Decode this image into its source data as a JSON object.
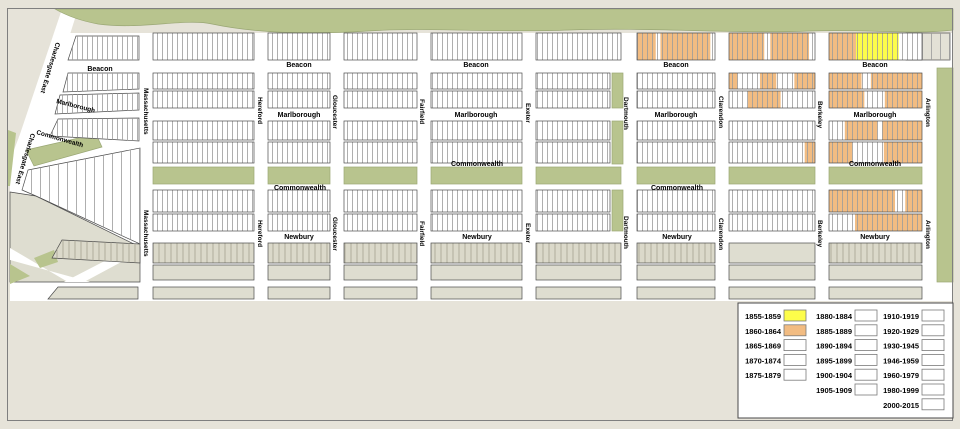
{
  "title": "Back Bay building construction era map",
  "colors": {
    "background": "#e6e3d9",
    "white": "#ffffff",
    "green": "#b8c48e",
    "green_edge": "#9aa775",
    "outline": "#4a4a4a",
    "parcel_line": "#9b9b9b",
    "gray_parcel_fill": "#dbd9ca",
    "gray_parcel_line": "#a4a291",
    "gray_plain": "#deddd0",
    "corner_gray": "#e3e1d6",
    "frame": "#7f7f7f",
    "legend_border": "#4a4a4a",
    "swatch_border": "#7a7a7a",
    "era_1855_1859": "#fdfd4a",
    "era_1860_1864": "#f2bc82"
  },
  "map": {
    "era_keys": {
      "O": "era_1860_1864",
      "Y": "era_1855_1859"
    },
    "cols": {
      "c1": {
        "x": 153,
        "w": 101
      },
      "c2": {
        "x": 268,
        "w": 62
      },
      "c3": {
        "x": 344,
        "w": 73
      },
      "c4": {
        "x": 431,
        "w": 91
      },
      "c5": {
        "x": 536,
        "w": 85
      },
      "c6": {
        "x": 637,
        "w": 78
      },
      "c7": {
        "x": 729,
        "w": 86
      },
      "c8": {
        "x": 829,
        "w": 93
      }
    },
    "rows": [
      {
        "y": 33,
        "h": 27,
        "type": "white",
        "seg": {
          "c6": [
            [
              0,
              0.24,
              "O"
            ],
            [
              0.3,
              0.94,
              "O"
            ]
          ],
          "c7": [
            [
              0,
              0.41,
              "O"
            ],
            [
              0.48,
              0.93,
              "O"
            ]
          ],
          "c8": [
            [
              0,
              0.29,
              "O"
            ],
            [
              0.29,
              0.75,
              "Y"
            ]
          ]
        }
      },
      {
        "y": 73,
        "h": 16,
        "type": "white",
        "c5w": 74,
        "seg": {
          "c7": [
            [
              0,
              0.1,
              "O"
            ],
            [
              0.36,
              0.55,
              "O"
            ],
            [
              0.76,
              1,
              "O"
            ]
          ],
          "c8": [
            [
              0,
              0.35,
              "O"
            ],
            [
              0.45,
              1,
              "O"
            ]
          ]
        }
      },
      {
        "y": 91,
        "h": 17,
        "type": "white",
        "c5w": 74,
        "seg": {
          "c7": [
            [
              0.22,
              0.6,
              "O"
            ]
          ],
          "c8": [
            [
              0,
              0.38,
              "O"
            ],
            [
              0.6,
              1,
              "O"
            ]
          ]
        }
      },
      {
        "y": 121,
        "h": 19,
        "type": "white",
        "c5w": 74,
        "seg": {
          "c8": [
            [
              0.17,
              0.52,
              "O"
            ],
            [
              0.57,
              1,
              "O"
            ]
          ]
        }
      },
      {
        "y": 142,
        "h": 21,
        "type": "white",
        "c5w": 74,
        "seg": {
          "c7": [
            [
              0.88,
              1,
              "O"
            ]
          ],
          "c8": [
            [
              0,
              0.25,
              "O"
            ],
            [
              0.59,
              1,
              "O"
            ]
          ]
        }
      },
      {
        "y": 190,
        "h": 22,
        "type": "white",
        "c5w": 74,
        "seg": {
          "c8": [
            [
              0,
              0.71,
              "O"
            ],
            [
              0.82,
              1,
              "O"
            ]
          ]
        }
      },
      {
        "y": 214,
        "h": 17,
        "type": "white",
        "c5w": 74,
        "seg": {
          "c8": [
            [
              0.28,
              1,
              "O"
            ]
          ]
        }
      },
      {
        "y": 243,
        "h": 20,
        "type": "grayp",
        "plain": [
          "c7"
        ]
      },
      {
        "y": 265,
        "h": 15,
        "type": "gray"
      },
      {
        "y": 287,
        "h": 12,
        "type": "gray"
      }
    ],
    "shapes": [
      {
        "n": "street-grid-base",
        "t": "poly",
        "p": "60,33 953,33 953,301 10,301 10,160",
        "f": "white"
      },
      {
        "n": "charlesgate-east-street",
        "t": "poly",
        "p": "62,9 78,9 30,161 14,152",
        "f": "white"
      },
      {
        "n": "esplanade-park",
        "t": "path",
        "d": "M55,9 L953,9 L953,30 C910,35 870,29 810,31 C730,34 650,27 570,30 C490,33 430,27 368,31 C305,35 255,33 212,24 C185,18 140,30 98,24 C76,20 62,13 55,9 Z",
        "f": "green",
        "o": 1
      },
      {
        "n": "commonwealth-mall-diagonal",
        "t": "poly",
        "p": "26,150 96,134 102,147 34,166",
        "f": "green",
        "o": 1
      },
      {
        "n": "commonwealth-mall",
        "t": "rect",
        "x": 153,
        "y": 167,
        "w": 101,
        "h": 17,
        "f": "green",
        "o": 1
      },
      {
        "n": "commonwealth-mall",
        "t": "rect",
        "x": 268,
        "y": 167,
        "w": 62,
        "h": 17,
        "f": "green",
        "o": 1
      },
      {
        "n": "commonwealth-mall",
        "t": "rect",
        "x": 344,
        "y": 167,
        "w": 73,
        "h": 17,
        "f": "green",
        "o": 1
      },
      {
        "n": "commonwealth-mall",
        "t": "rect",
        "x": 431,
        "y": 167,
        "w": 91,
        "h": 17,
        "f": "green",
        "o": 1
      },
      {
        "n": "commonwealth-mall",
        "t": "rect",
        "x": 536,
        "y": 167,
        "w": 85,
        "h": 17,
        "f": "green",
        "o": 1
      },
      {
        "n": "commonwealth-mall",
        "t": "rect",
        "x": 637,
        "y": 167,
        "w": 78,
        "h": 17,
        "f": "green",
        "o": 1
      },
      {
        "n": "commonwealth-mall",
        "t": "rect",
        "x": 729,
        "y": 167,
        "w": 86,
        "h": 17,
        "f": "green",
        "o": 1
      },
      {
        "n": "commonwealth-mall",
        "t": "rect",
        "x": 829,
        "y": 167,
        "w": 93,
        "h": 17,
        "f": "green",
        "o": 1
      },
      {
        "n": "dartmouth-green-strip",
        "t": "rect",
        "x": 612,
        "y": 73,
        "w": 11,
        "h": 35,
        "f": "green",
        "o": 1
      },
      {
        "n": "dartmouth-green-strip",
        "t": "rect",
        "x": 612,
        "y": 121,
        "w": 11,
        "h": 43,
        "f": "green",
        "o": 1
      },
      {
        "n": "dartmouth-green-strip",
        "t": "rect",
        "x": 612,
        "y": 190,
        "w": 11,
        "h": 41,
        "f": "green",
        "o": 1
      },
      {
        "n": "public-garden-strip",
        "t": "rect",
        "x": 937,
        "y": 68,
        "w": 16,
        "h": 214,
        "f": "green",
        "o": 1
      },
      {
        "n": "bottomleft-gray-blocks",
        "t": "poly",
        "p": "10,192 36,196 140,247 140,282 10,282",
        "f": "gray_plain",
        "o": 1
      },
      {
        "n": "diagonal-street",
        "t": "poly",
        "p": "10,248 10,260 90,282 68,282",
        "f": "white"
      },
      {
        "n": "diagonal-street",
        "t": "poly",
        "p": "64,282 126,250 140,252 84,282",
        "f": "white"
      },
      {
        "n": "green-sliver",
        "t": "poly",
        "p": "8,130 16,133 10,186 8,186",
        "f": "green"
      },
      {
        "n": "green-sliver",
        "t": "poly",
        "p": "10,264 30,276 10,284",
        "f": "green"
      },
      {
        "n": "green-sliver",
        "t": "poly",
        "p": "34,258 54,250 58,262 40,268",
        "f": "green"
      },
      {
        "n": "parcel-block",
        "t": "poly",
        "p": "76,36 139,36 139,60 68,60",
        "f": "white",
        "pat": "pv",
        "o": 1
      },
      {
        "n": "parcel-block",
        "t": "poly",
        "p": "68,73 139,73 139,89 63,92",
        "f": "white",
        "pat": "pv",
        "o": 1
      },
      {
        "n": "parcel-block",
        "t": "poly",
        "p": "60,95 139,93 139,110 55,114",
        "f": "white",
        "pat": "pv",
        "o": 1
      },
      {
        "n": "parcel-block",
        "t": "poly",
        "p": "58,119 139,118 139,141 50,136",
        "f": "white",
        "pat": "pv",
        "o": 1
      },
      {
        "n": "parcel-block",
        "t": "poly",
        "p": "28,170 140,148 140,244 36,196 22,190",
        "f": "white",
        "pat": "pvs",
        "o": 1
      },
      {
        "n": "gray-parcel-block",
        "t": "poly",
        "p": "62,240 140,244 140,263 52,258",
        "f": "gray_parcel_fill",
        "pat": "pg",
        "o": 1
      },
      {
        "n": "gray-block",
        "t": "poly",
        "p": "58,287 138,287 138,299 48,299",
        "f": "gray_plain",
        "o": 1
      },
      {
        "n": "corner-block",
        "t": "rect",
        "x": 906,
        "y": 33,
        "w": 44,
        "h": 27,
        "f": "corner_gray",
        "pat": "pvs",
        "o": 1
      }
    ],
    "labels": [
      {
        "text": "Beacon",
        "x": 100,
        "y": 71
      },
      {
        "text": "Beacon",
        "x": 299,
        "y": 67
      },
      {
        "text": "Beacon",
        "x": 476,
        "y": 67
      },
      {
        "text": "Beacon",
        "x": 676,
        "y": 67
      },
      {
        "text": "Beacon",
        "x": 875,
        "y": 67
      },
      {
        "text": "Marlborough",
        "x": 299,
        "y": 117
      },
      {
        "text": "Marlborough",
        "x": 476,
        "y": 117
      },
      {
        "text": "Marlborough",
        "x": 676,
        "y": 117
      },
      {
        "text": "Marlborough",
        "x": 875,
        "y": 117
      },
      {
        "text": "Commonwealth",
        "x": 300,
        "y": 190
      },
      {
        "text": "Commonwealth",
        "x": 477,
        "y": 166
      },
      {
        "text": "Commonwealth",
        "x": 677,
        "y": 190
      },
      {
        "text": "Commonwealth",
        "x": 875,
        "y": 166
      },
      {
        "text": "Newbury",
        "x": 299,
        "y": 239
      },
      {
        "text": "Newbury",
        "x": 477,
        "y": 239
      },
      {
        "text": "Newbury",
        "x": 677,
        "y": 239
      },
      {
        "text": "Newbury",
        "x": 875,
        "y": 239
      },
      {
        "text": "Marlborough",
        "x": 56,
        "y": 103,
        "r": 14,
        "a": "start",
        "s": 6.5
      },
      {
        "text": "Commonwealth",
        "x": 36,
        "y": 134,
        "r": 16,
        "a": "start",
        "s": 6.5
      },
      {
        "text": "Charlesgate East",
        "x": 56,
        "y": 42,
        "r": 107,
        "a": "start",
        "s": 6.5
      },
      {
        "text": "Charlesgate East",
        "x": 31,
        "y": 133,
        "r": 107,
        "a": "start",
        "s": 6.5
      },
      {
        "text": "Massachusetts",
        "x": 144,
        "y": 88,
        "r": 90,
        "a": "start",
        "s": 6.5
      },
      {
        "text": "Massachusetts",
        "x": 144,
        "y": 210,
        "r": 90,
        "a": "start",
        "s": 6.5
      },
      {
        "text": "Hereford",
        "x": 258,
        "y": 97,
        "r": 90,
        "a": "start",
        "s": 6.5
      },
      {
        "text": "Hereford",
        "x": 258,
        "y": 220,
        "r": 90,
        "a": "start",
        "s": 6.5
      },
      {
        "text": "Gloucester",
        "x": 333,
        "y": 95,
        "r": 90,
        "a": "start",
        "s": 6.5
      },
      {
        "text": "Gloucester",
        "x": 333,
        "y": 217,
        "r": 90,
        "a": "start",
        "s": 6.5
      },
      {
        "text": "Fairfield",
        "x": 420,
        "y": 99,
        "r": 90,
        "a": "start",
        "s": 6.5
      },
      {
        "text": "Fairfield",
        "x": 420,
        "y": 221,
        "r": 90,
        "a": "start",
        "s": 6.5
      },
      {
        "text": "Exeter",
        "x": 526,
        "y": 103,
        "r": 90,
        "a": "start",
        "s": 6.5
      },
      {
        "text": "Exeter",
        "x": 526,
        "y": 223,
        "r": 90,
        "a": "start",
        "s": 6.5
      },
      {
        "text": "Dartmouth",
        "x": 624,
        "y": 97,
        "r": 90,
        "a": "start",
        "s": 6.5
      },
      {
        "text": "Dartmouth",
        "x": 624,
        "y": 216,
        "r": 90,
        "a": "start",
        "s": 6.5
      },
      {
        "text": "Clarendon",
        "x": 719,
        "y": 96,
        "r": 90,
        "a": "start",
        "s": 6.5
      },
      {
        "text": "Clarendon",
        "x": 719,
        "y": 218,
        "r": 90,
        "a": "start",
        "s": 6.5
      },
      {
        "text": "Berkeley",
        "x": 818,
        "y": 101,
        "r": 90,
        "a": "start",
        "s": 6.5
      },
      {
        "text": "Berkeley",
        "x": 818,
        "y": 220,
        "r": 90,
        "a": "start",
        "s": 6.5
      },
      {
        "text": "Arlington",
        "x": 926,
        "y": 98,
        "r": 90,
        "a": "start",
        "s": 6.5
      },
      {
        "text": "Arlington",
        "x": 926,
        "y": 220,
        "r": 90,
        "a": "start",
        "s": 6.5
      }
    ]
  },
  "legend": {
    "box": {
      "x": 738,
      "y": 303,
      "w": 215,
      "h": 115
    },
    "row_start": 319,
    "row_step": 14.8,
    "swatch": {
      "w": 22,
      "h": 11
    },
    "columns": [
      {
        "label_x": 781,
        "swatch_x": 784,
        "items": [
          {
            "label": "1855-1859",
            "color": "era_1855_1859"
          },
          {
            "label": "1860-1864",
            "color": "era_1860_1864"
          },
          {
            "label": "1865-1869",
            "color": "white"
          },
          {
            "label": "1870-1874",
            "color": "white"
          },
          {
            "label": "1875-1879",
            "color": "white"
          }
        ]
      },
      {
        "label_x": 852,
        "swatch_x": 855,
        "items": [
          {
            "label": "1880-1884",
            "color": "white"
          },
          {
            "label": "1885-1889",
            "color": "white"
          },
          {
            "label": "1890-1894",
            "color": "white"
          },
          {
            "label": "1895-1899",
            "color": "white"
          },
          {
            "label": "1900-1904",
            "color": "white"
          },
          {
            "label": "1905-1909",
            "color": "white"
          }
        ]
      },
      {
        "label_x": 919,
        "swatch_x": 922,
        "items": [
          {
            "label": "1910-1919",
            "color": "white"
          },
          {
            "label": "1920-1929",
            "color": "white"
          },
          {
            "label": "1930-1945",
            "color": "white"
          },
          {
            "label": "1946-1959",
            "color": "white"
          },
          {
            "label": "1960-1979",
            "color": "white"
          },
          {
            "label": "1980-1999",
            "color": "white"
          },
          {
            "label": "2000-2015",
            "color": "white"
          }
        ]
      }
    ]
  }
}
